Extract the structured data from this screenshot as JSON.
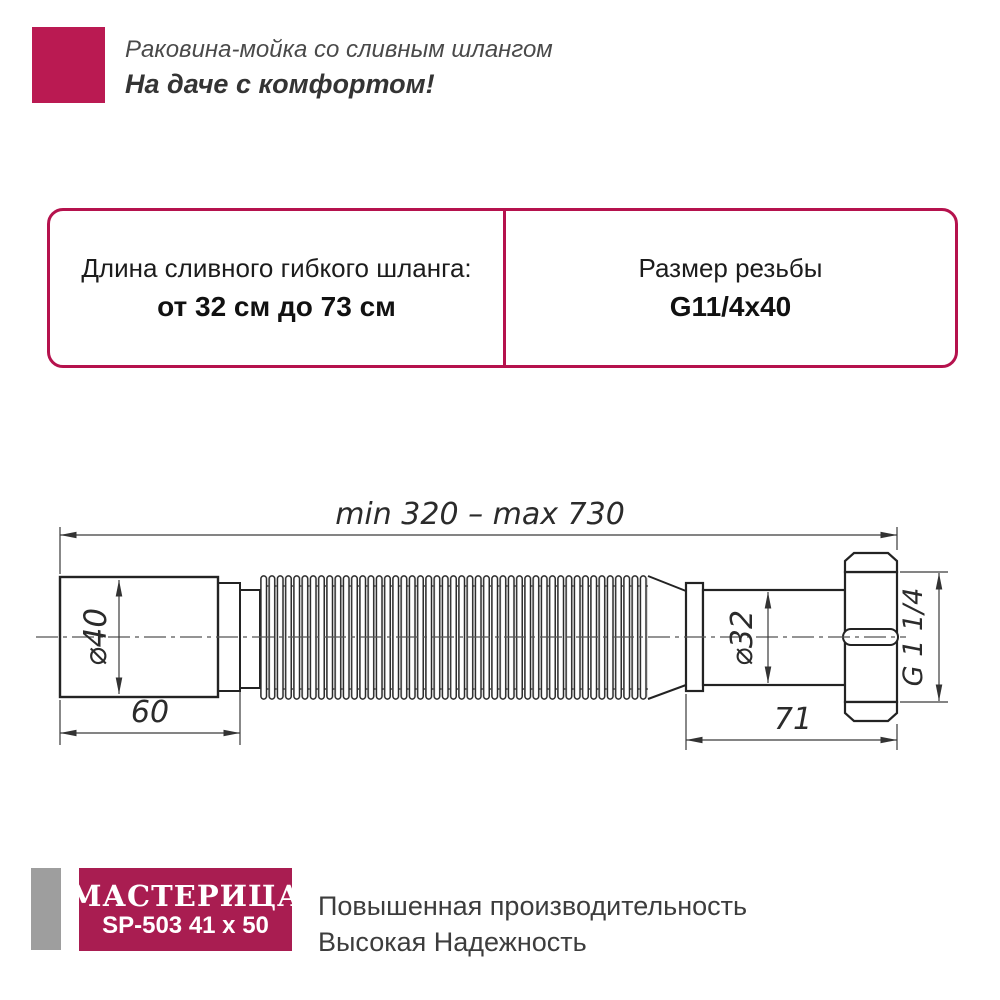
{
  "header": {
    "subtitle": "Раковина-мойка со сливным шлангом",
    "slogan": "На даче с комфортом!"
  },
  "specs": {
    "left_label": "Длина сливного гибкого шланга:",
    "left_value": "от 32 см до 73 см",
    "right_label": "Размер резьбы",
    "right_value": "G11/4x40"
  },
  "diagram": {
    "length_range": "min 320 – max 730",
    "diameter_left": "⌀40",
    "left_section_length": "60",
    "diameter_right": "⌀32",
    "right_section_length": "71",
    "thread_size": "G 1 1/4"
  },
  "footer": {
    "brand": "МАСТЕРИЦА",
    "model": "SP-503 41 x 50",
    "tagline_line1": "Повышенная производительность",
    "tagline_line2": "Высокая Надежность"
  },
  "colors": {
    "accent_border": "#b5124d",
    "logo_square": "#ba1a52",
    "brand_box": "#a91d51",
    "gray_bar": "#9e9e9e"
  }
}
